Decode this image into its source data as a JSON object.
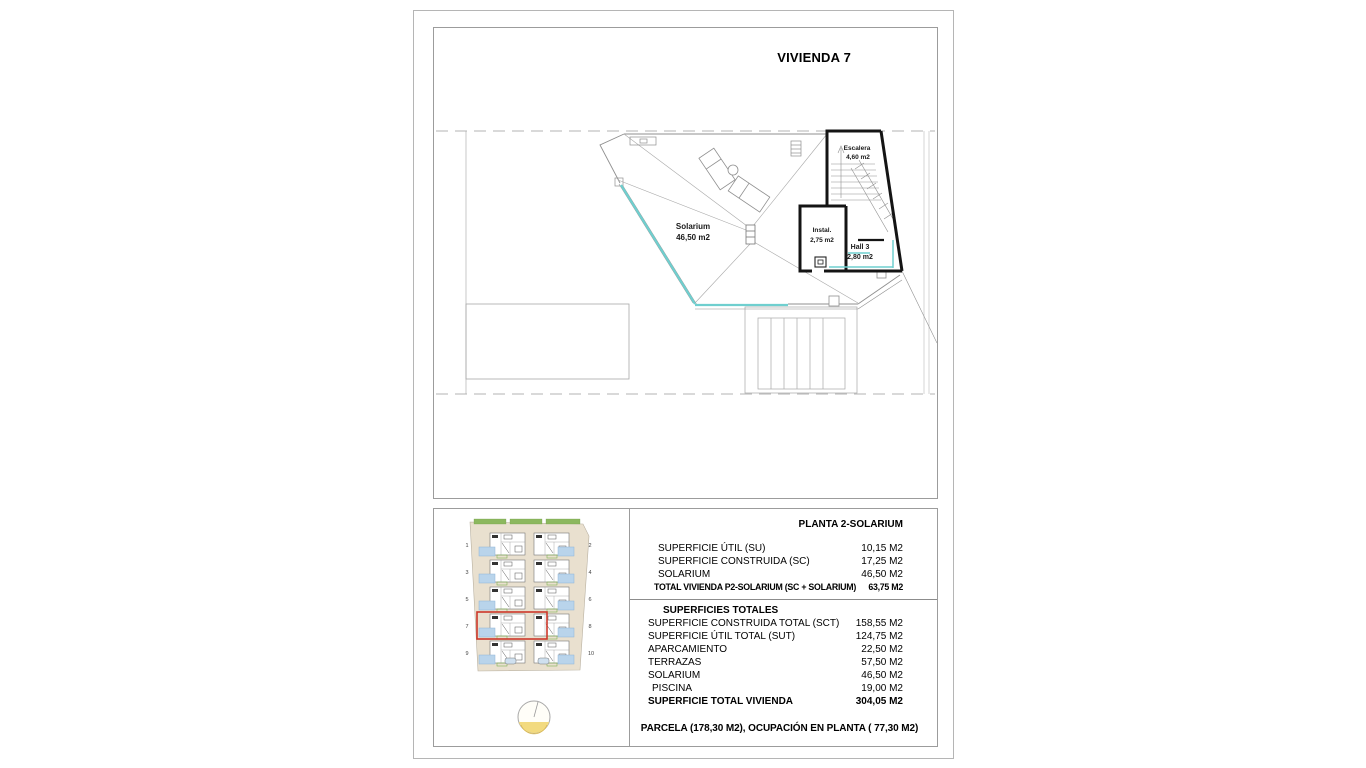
{
  "page": {
    "title": "VIVIENDA 7"
  },
  "floor_plan": {
    "labels": {
      "solarium_name": "Solarium",
      "solarium_area": "46,50 m2",
      "escalera_name": "Escalera",
      "escalera_area": "4,60 m2",
      "instal_name": "Instal.",
      "instal_area": "2,75 m2",
      "hall_name": "Hall 3",
      "hall_area": "2,80 m2"
    },
    "colors": {
      "railing": "#6FCFCF",
      "wall": "#141414",
      "line": "#9A9A9A"
    }
  },
  "site_plan": {
    "unit_numbers_left": [
      "1",
      "3",
      "5",
      "7",
      "9"
    ],
    "unit_numbers_right": [
      "2",
      "4",
      "6",
      "8",
      "10"
    ],
    "highlighted_unit": "7",
    "colors": {
      "highlight": "#CD372A",
      "pool": "#B9D4EB",
      "plot": "#E9E0CF",
      "green": "#7FB254",
      "compass": "#F2DA7F"
    }
  },
  "table": {
    "header": "PLANTA 2-SOLARIUM",
    "section1": [
      {
        "label": "SUPERFICIE ÚTIL (SU)",
        "value": "10,15 M2"
      },
      {
        "label": "SUPERFICIE CONSTRUIDA (SC)",
        "value": "17,25 M2"
      },
      {
        "label": "SOLARIUM",
        "value": "46,50 M2"
      },
      {
        "label": "TOTAL VIVIENDA P2-SOLARIUM (SC + SOLARIUM)",
        "value": "63,75 M2"
      }
    ],
    "section2_title": "SUPERFICIES TOTALES",
    "section2": [
      {
        "label": "SUPERFICIE CONSTRUIDA TOTAL (SCT)",
        "value": "158,55 M2"
      },
      {
        "label": "SUPERFICIE ÚTIL TOTAL (SUT)",
        "value": "124,75 M2"
      },
      {
        "label": "APARCAMIENTO",
        "value": "22,50 M2"
      },
      {
        "label": "TERRAZAS",
        "value": "57,50 M2"
      },
      {
        "label": "SOLARIUM",
        "value": "46,50 M2"
      },
      {
        "label": "PISCINA",
        "value": "19,00 M2"
      },
      {
        "label": "SUPERFICIE TOTAL VIVIENDA",
        "value": "304,05 M2"
      }
    ],
    "footer": "PARCELA  (178,30 M2), OCUPACIÓN EN PLANTA ( 77,30 M2)"
  }
}
